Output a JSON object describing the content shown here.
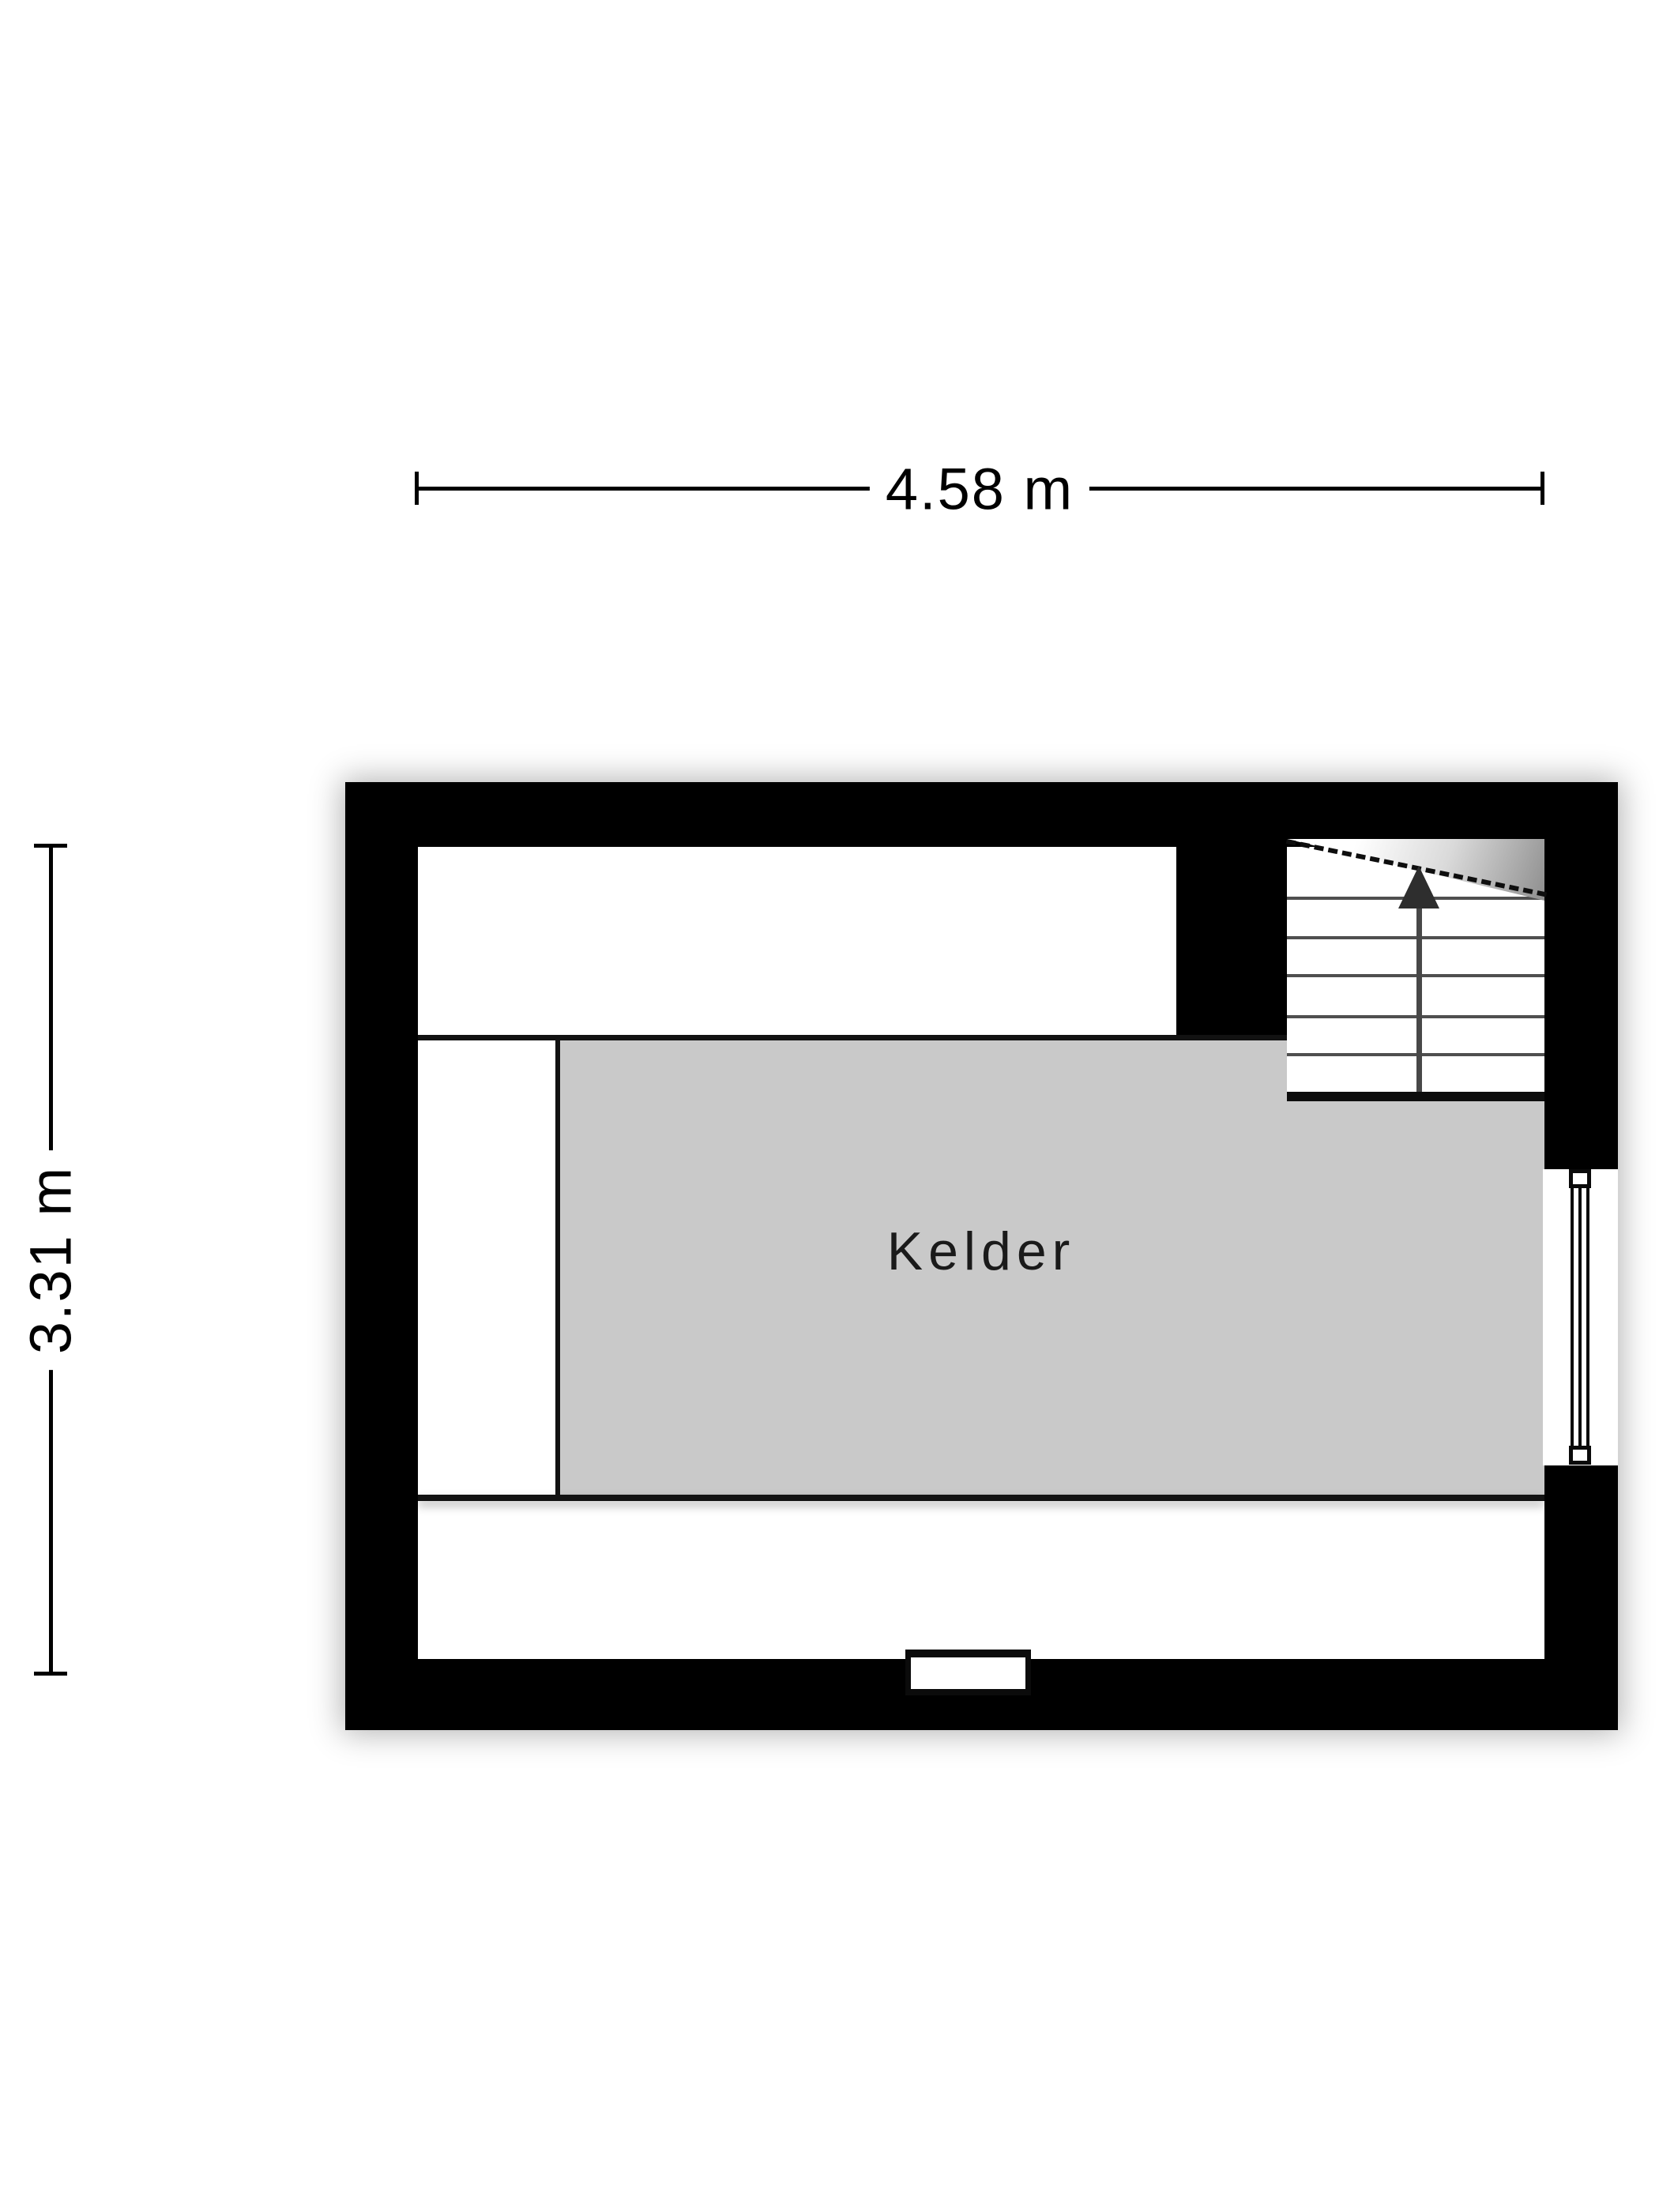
{
  "floorplan": {
    "room": {
      "label": "Kelder",
      "fill_color": "#c9c9c9"
    },
    "dimensions": {
      "width_label": "4.58 m",
      "height_label": "3.31 m",
      "width_m": 4.58,
      "height_m": 3.31
    },
    "stairs": {
      "tread_count": 6,
      "direction": "up",
      "has_break_line": true
    },
    "features": {
      "window": "right-wall-window",
      "door": "bottom-wall-niche"
    },
    "colors": {
      "wall": "#000000",
      "interior": "#ffffff",
      "room_fill": "#c9c9c9",
      "line": "#121212",
      "tread": "#4f4f4f",
      "arrow": "#2e2e2e",
      "text": "#1a1a1a"
    }
  }
}
